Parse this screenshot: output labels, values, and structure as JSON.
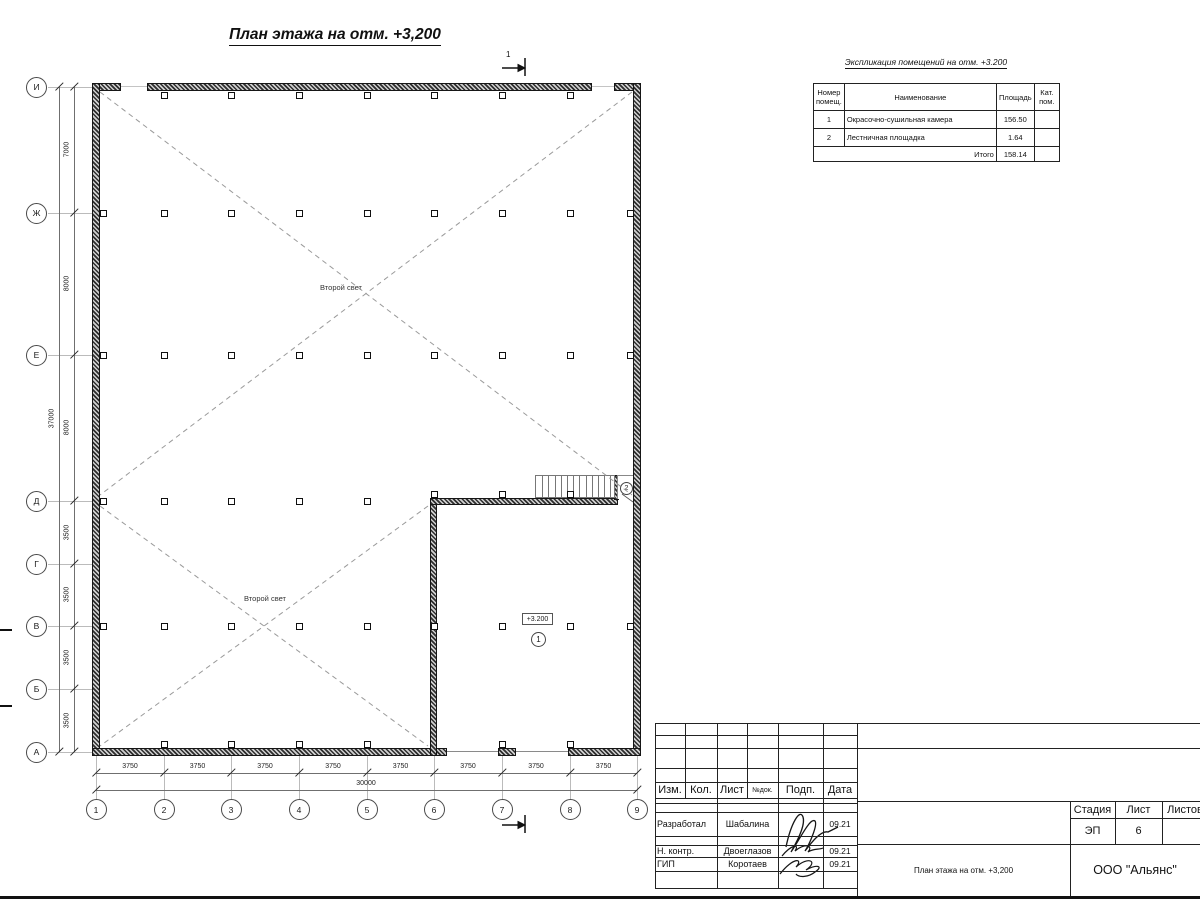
{
  "drawing": {
    "title": "План этажа на отм. +3,200",
    "second_light": "Второй свет",
    "level_mark": "+3.200",
    "room1_mark": "1",
    "room2_mark": "2",
    "section_mark": "1",
    "axes_left": [
      "И",
      "Ж",
      "Е",
      "Д",
      "Г",
      "В",
      "Б",
      "А"
    ],
    "axes_bottom": [
      "1",
      "2",
      "3",
      "4",
      "5",
      "6",
      "7",
      "8",
      "9"
    ],
    "dims_left": [
      "7000",
      "8000",
      "8000",
      "3500",
      "3500",
      "3500",
      "3500"
    ],
    "dims_left_total": "37000",
    "dims_bottom": [
      "3750",
      "3750",
      "3750",
      "3750",
      "3750",
      "3750",
      "3750",
      "3750"
    ],
    "dims_bottom_total": "30000"
  },
  "legend": {
    "title": "Экспликация помещений на отм. +3.200",
    "col_headers": [
      "Номер помещ.",
      "Наименование",
      "Площадь",
      "Кат. пом."
    ],
    "rows": [
      {
        "num": "1",
        "name": "Окрасочно-сушильная камера",
        "area": "156.50",
        "cat": ""
      },
      {
        "num": "2",
        "name": "Лестничная площадка",
        "area": "1.64",
        "cat": ""
      }
    ],
    "total_label": "Итого",
    "total_area": "158.14"
  },
  "title_block": {
    "cols": [
      "Изм.",
      "Кол.",
      "Лист",
      "№док.",
      "Подп.",
      "Дата"
    ],
    "people": [
      {
        "role": "Разработал",
        "name": "Шабалина",
        "date": "09.21"
      },
      {
        "role": "Н. контр.",
        "name": "Двоеглазов",
        "date": "09.21"
      },
      {
        "role": "ГИП",
        "name": "Коротаев",
        "date": "09.21"
      }
    ],
    "stage_label": "Стадия",
    "sheet_label": "Лист",
    "sheets_label": "Листов",
    "stage": "ЭП",
    "sheet_no": "6",
    "doc_name": "План этажа на отм. +3,200",
    "company": "ООО \"Альянс\""
  }
}
